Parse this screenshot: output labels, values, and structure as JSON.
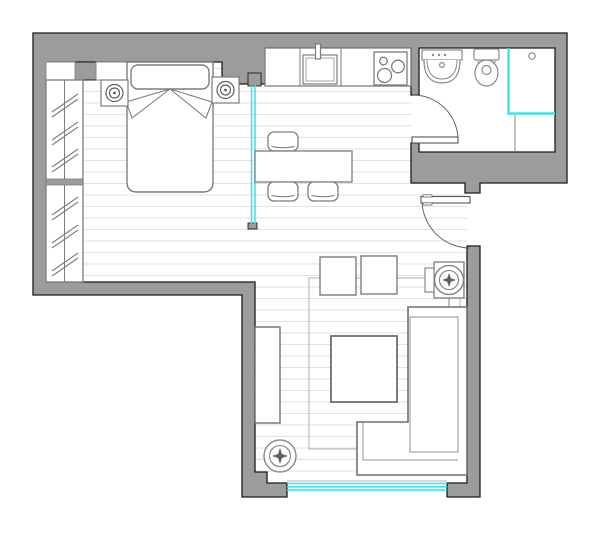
{
  "meta": {
    "type": "floor-plan",
    "description": "Architectural floor plan of a studio apartment, top-down view, no text labels"
  },
  "colors": {
    "wall": "#9c9c9c",
    "wall_outline": "#1b1b1b",
    "glass": "#35e6ef",
    "floor_line": "#e2e2e2",
    "furniture_stroke": "#7d7d7d",
    "fixture_stroke": "#8a8a8a",
    "rug_stroke": "#bcbcbc",
    "door_stroke": "#666666",
    "background": "#ffffff"
  },
  "rooms": [
    {
      "name": "sleeping-area",
      "furniture": [
        "double-bed",
        "pillow-headboard",
        "blanket-fold",
        "nightstand-left",
        "nightstand-right",
        "table-lamp-left",
        "table-lamp-right",
        "sliding-wardrobe",
        "wall-niche-left",
        "wall-niche-right"
      ]
    },
    {
      "name": "kitchen-dining-area",
      "furniture": [
        "kitchen-counter",
        "kitchen-sink",
        "faucet",
        "cooktop-3-burners",
        "dining-table",
        "dining-chair-top",
        "dining-chair-bottom-left",
        "dining-chair-bottom-right",
        "glass-partition"
      ]
    },
    {
      "name": "bathroom",
      "furniture": [
        "washbasin-vanity",
        "toilet",
        "shower-glass-screen",
        "shower-head",
        "bathroom-door"
      ]
    },
    {
      "name": "living-area",
      "furniture": [
        "corner-sofa",
        "coffee-table",
        "rug",
        "pouf-left",
        "pouf-right",
        "swivel-armchair",
        "side-table",
        "floor-lamp",
        "low-cabinet"
      ]
    },
    {
      "name": "entry",
      "furniture": [
        "entry-door"
      ]
    }
  ],
  "openings": {
    "windows": [
      "living-room-window-bottom"
    ],
    "doors": [
      "entry-door-right-wall",
      "bathroom-door"
    ],
    "glass_elements": [
      "dining-glass-partition",
      "shower-glass-screen",
      "living-room-window"
    ]
  },
  "floor": {
    "pattern": "horizontal-plank-lines",
    "plank_spacing_px": 11.5
  }
}
